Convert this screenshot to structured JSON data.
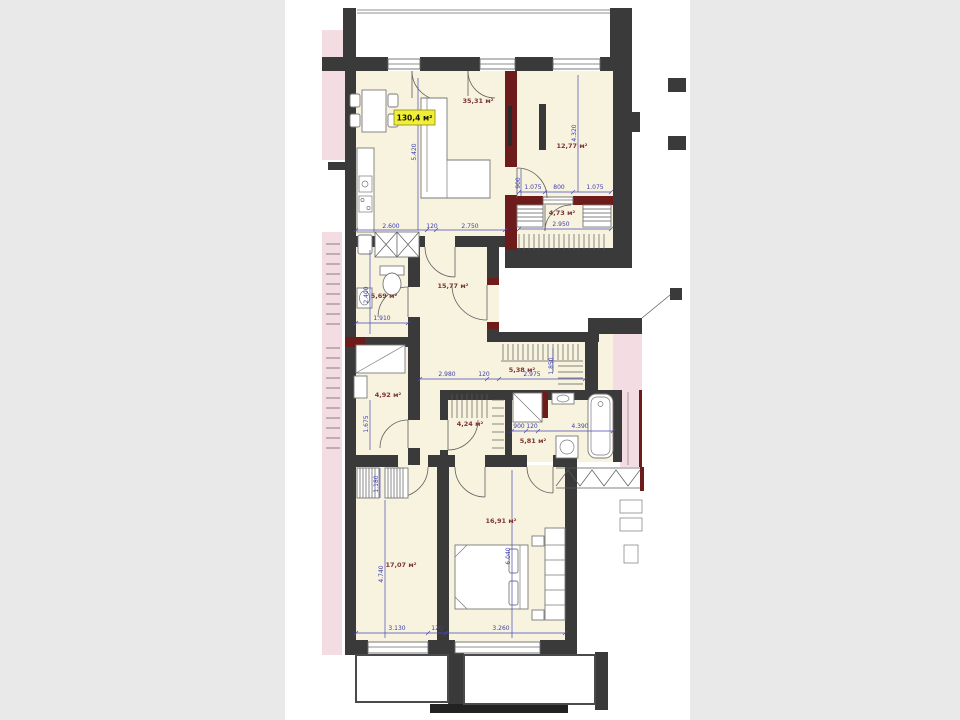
{
  "image_type": "apartment-floor-plan",
  "colors": {
    "page_background": "#e9e9e9",
    "canvas": "#ffffff",
    "walls": "#3a3a3a",
    "accent_walls": "#6e1b1b",
    "room_fill": "#f7f3df",
    "common_area_pink": "#f3dce2",
    "dimension_blue": "#3c3cae",
    "area_label_red": "#7b3434",
    "total_label_bg": "#f0ee35"
  },
  "total_area": "130,4 м²",
  "rooms": [
    {
      "name": "kitchen-living-room",
      "area": "35,31 м²"
    },
    {
      "name": "bedroom-top",
      "area": "12,77 м²"
    },
    {
      "name": "loggia",
      "area": "4,73 м²"
    },
    {
      "name": "hallway",
      "area": "15,77 м²"
    },
    {
      "name": "bathroom",
      "area": "5,69 м²"
    },
    {
      "name": "laundry",
      "area": "4,92 м²"
    },
    {
      "name": "wardrobe",
      "area": "5,38 м²"
    },
    {
      "name": "walk-in-closet",
      "area": "4,24 м²"
    },
    {
      "name": "shower-room",
      "area": "5,81 м²"
    },
    {
      "name": "bedroom-left",
      "area": "17,07 м²"
    },
    {
      "name": "bedroom-right",
      "area": "16,91 м²"
    }
  ],
  "dims": {
    "lk_a": "2.600",
    "lk_gap": "120",
    "lk_b": "2.750",
    "lk_h": "5.420",
    "lk_door": "900",
    "bt_h": "4.320",
    "lg_a": "1.075",
    "lg_b": "800",
    "lg_c": "1.075",
    "lg_w": "2.950",
    "hw_w": "2.980",
    "hw_gap": "120",
    "ba_w": "1.910",
    "ba_h": "2.400",
    "ld_h": "1.675",
    "wd_w": "2.975",
    "wd_h": "1.850",
    "sh_a": "900",
    "sh_b": "120",
    "sh_w": "4.390",
    "b2_niche": "1.180",
    "b2_h": "4.740",
    "b2_w": "3.130",
    "bt_gap": "120",
    "b3_h": "6.040",
    "b3_w": "3.260"
  }
}
